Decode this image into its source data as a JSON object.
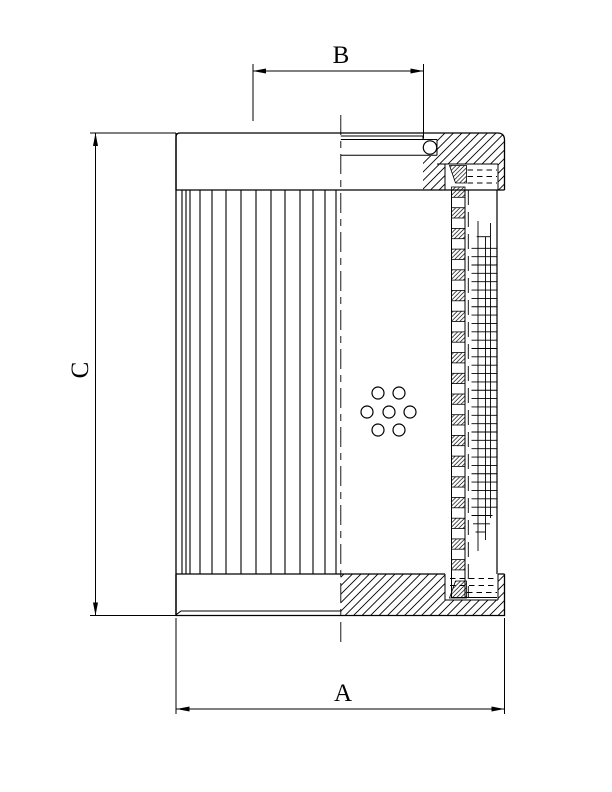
{
  "figure": {
    "kind": "technical-section-drawing",
    "subject": "filter-element-cross-section"
  },
  "style": {
    "ink": "#000000",
    "paper": "#ffffff"
  },
  "labels": {
    "a": "A",
    "b": "B",
    "c": "C"
  },
  "geometry": {
    "canvas": {
      "w": 612,
      "h": 792
    },
    "pleats": {
      "lines": [
        182,
        186,
        190,
        200,
        212,
        226,
        241,
        256,
        271,
        285,
        300,
        313,
        325,
        336
      ],
      "top": 190,
      "bottom": 574
    },
    "perforations": {
      "r": 6,
      "centers": [
        [
          378,
          393
        ],
        [
          399,
          393
        ],
        [
          367,
          412
        ],
        [
          389,
          412
        ],
        [
          410,
          412
        ],
        [
          378,
          430
        ],
        [
          399,
          430
        ]
      ]
    },
    "mesh": {
      "x1": 471.5,
      "x2": 497,
      "y0": 248.3,
      "step": 8.35,
      "rows": 32,
      "partial_rows": [
        [
          476.7,
          490,
          236.7
        ],
        [
          471.5,
          492.5,
          515.5
        ],
        [
          473,
          490,
          523.8
        ],
        [
          475.5,
          485,
          532
        ]
      ],
      "verticals": [
        [
          478,
          221,
          551
        ],
        [
          485.5,
          237,
          540
        ],
        [
          490.5,
          223,
          518
        ]
      ]
    },
    "checker": {
      "x": 451.5,
      "w": 13.5,
      "y0": 187,
      "period": 20.7,
      "h": 10.3,
      "count": 19
    },
    "seal_top_rows": [
      [
        467.5,
        497,
        170
      ],
      [
        467.5,
        497,
        176.5
      ],
      [
        467.5,
        497,
        183
      ]
    ],
    "seal_bottom_rows": [
      [
        450,
        497,
        578.5
      ],
      [
        450,
        497,
        585.5
      ],
      [
        467,
        497,
        592.5
      ]
    ],
    "centerline": {
      "x": 340.8,
      "y1": 115,
      "y2": 647
    },
    "dims": {
      "a": {
        "line": [
          176.5,
          709,
          504.5,
          709
        ],
        "ext": [
          [
            176,
            618,
            176,
            714
          ],
          [
            504.5,
            618,
            504.5,
            714
          ]
        ]
      },
      "b": {
        "line": [
          253,
          71,
          423.5,
          71
        ],
        "ext": [
          [
            253,
            64,
            253,
            121
          ],
          [
            423.5,
            64,
            423.5,
            138.5
          ]
        ]
      },
      "c": {
        "line": [
          95.5,
          133,
          95.5,
          615.5
        ],
        "ext": [
          [
            90,
            133,
            176,
            133
          ],
          [
            90,
            615.5,
            176,
            615.5
          ]
        ]
      }
    }
  }
}
